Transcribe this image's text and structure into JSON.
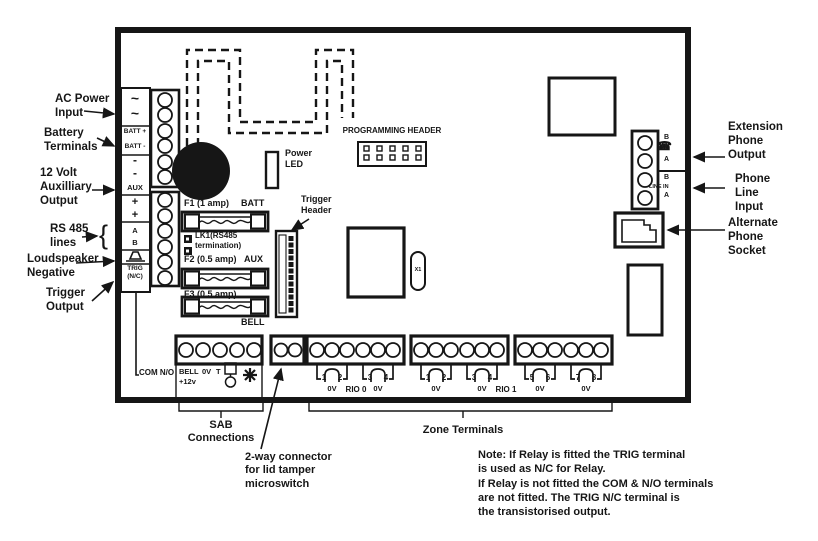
{
  "callouts": {
    "left": [
      {
        "id": "ac-power",
        "label": "AC Power\nInput"
      },
      {
        "id": "battery",
        "label": "Battery\nTerminals"
      },
      {
        "id": "aux-12v",
        "label": "12 Volt\nAuxilliary\nOutput"
      },
      {
        "id": "rs485",
        "label": "RS 485\nlines"
      },
      {
        "id": "loudspeaker",
        "label": "Loudspeaker\nNegative"
      },
      {
        "id": "trigger",
        "label": "Trigger\nOutput"
      }
    ],
    "right": [
      {
        "id": "extension-phone",
        "label": "Extension\nPhone\nOutput"
      },
      {
        "id": "phone-line",
        "label": "Phone\nLine\nInput"
      },
      {
        "id": "alternate-phone",
        "label": "Alternate\nPhone\nSocket"
      }
    ],
    "bottom": {
      "sab": "SAB\nConnections",
      "tamper": "2-way connector\nfor lid tamper\nmicroswitch",
      "zones": "Zone Terminals"
    }
  },
  "terminal_strip": {
    "labels": [
      "~",
      "~",
      "BATT +",
      "BATT -",
      "-",
      "-",
      "AUX",
      "+",
      "+",
      "A",
      "B"
    ],
    "trig": "TRIG\n(N/C)"
  },
  "board": {
    "programming_header": "PROGRAMMING HEADER",
    "power_led": "Power\nLED",
    "trigger_header": "Trigger\nHeader",
    "fuses": [
      {
        "name": "F1 (1 amp)",
        "assoc": "BATT"
      },
      {
        "name": "F2 (0.5 amp)",
        "assoc": "AUX"
      },
      {
        "name": "F3 (0.5 amp)",
        "assoc": "BELL"
      }
    ],
    "lk1": "LK1(RS485\ntermination)",
    "crystal": "X1",
    "phone_terminals": {
      "ext_b": "B",
      "ext_a": "A",
      "line_b": "B",
      "line_in": "LINE IN",
      "line_a": "A"
    },
    "com_no": "COM N/O",
    "sab_labels": {
      "bell": "BELL",
      "zero_v": "0V",
      "plus_12v": "+12v",
      "t": "T"
    },
    "zone_groups": [
      {
        "rio": "RIO 0",
        "pairs": [
          {
            "left": "1",
            "mid": "0V",
            "right": "2"
          },
          {
            "left": "3",
            "mid": "0V",
            "right": "4"
          }
        ]
      },
      {
        "rio": "RIO 1",
        "pairs": [
          {
            "left": "1",
            "mid": "0V",
            "right": "2"
          },
          {
            "left": "3",
            "mid": "0V",
            "right": "4"
          }
        ]
      },
      {
        "rio": "",
        "pairs": [
          {
            "left": "5",
            "mid": "0V",
            "right": "6"
          },
          {
            "left": "7",
            "mid": "0V",
            "right": "8"
          }
        ]
      }
    ]
  },
  "note": "Note: If Relay is fitted the TRIG terminal\nis used as N/C for Relay.\nIf Relay is not fitted the COM & N/O terminals\nare not fitted. The TRIG N/C terminal is\nthe transistorised output."
}
